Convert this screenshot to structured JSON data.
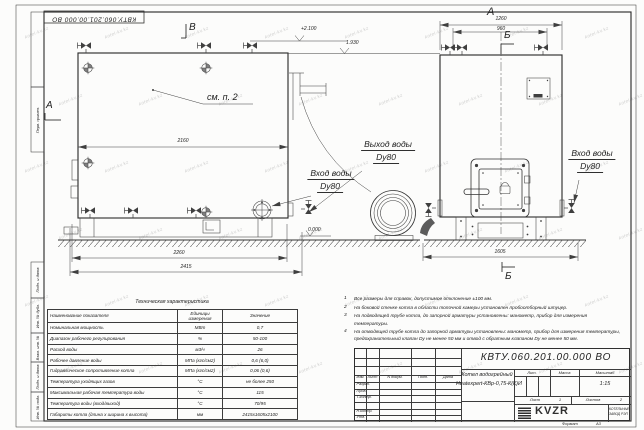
{
  "sheet": {
    "designation_stamp": "КВТУ.060.201.00.000  ВО",
    "format_label": "Формат",
    "format_value": "А3",
    "watermark": "kotel-kv.kz"
  },
  "frame_labels": {
    "perv": "Перв. примен.",
    "podp1": "Подп. и дата",
    "inv_dubl": "Инв. № дубл.",
    "vzam": "Взам. инв. №",
    "podp2": "Подп. и дата",
    "inv_podl": "Инв. № подл."
  },
  "front_view": {
    "section_v": "В",
    "section_a": "А",
    "note_ref": "см. п. 2",
    "dim_2160": "2160",
    "dim_2260": "2260",
    "dim_2415": "2415",
    "level_top": "+2.100",
    "level_chimney": "1.930",
    "level_zero": "0.000",
    "outlet_line1": "Выход воды",
    "outlet_line2": "Dy80",
    "inlet_line1": "Вход воды",
    "inlet_line2": "Dy80"
  },
  "side_view": {
    "view_label": "А",
    "dim_1260": "1260",
    "dim_960": "960",
    "dim_1605": "1605",
    "section_b_top": "Б",
    "section_b_bottom": "Б",
    "inlet_line1": "Вход воды",
    "inlet_line2": "Dy80"
  },
  "notes": [
    {
      "num": "1",
      "text": "Все размеры для справок, допустимое отклонение ±100 мм."
    },
    {
      "num": "2",
      "text": "На боковой стенке котла в области топочной камеры установлен пробоотборный штуцер."
    },
    {
      "num": "3",
      "text": "На  подводящей трубе котла, до запорной арматуры установлены: манометр, прибор для измерения\nтемпературы."
    },
    {
      "num": "4",
      "text": "На отводящей трубе котла до запорной арматуры установлены: манометр, прибор для измерения температуры,\nпредохранительный клапан Dу не менее 50 мм и отвод с обратным клапаном Dу не менее 50 мм."
    }
  ],
  "spec_table": {
    "title": "Техническая характеристика",
    "col_headers": [
      "Наименование показателя",
      "Единицы измерения",
      "Значение"
    ],
    "rows": [
      {
        "name": "Номинальная мощность",
        "unit": "МВт",
        "value": "0,7"
      },
      {
        "name": "Диапазон рабочего регулирования",
        "unit": "%",
        "value": "50-100"
      },
      {
        "name": "Расход воды",
        "unit": "м3/ч",
        "value": "26"
      },
      {
        "name": "Рабочее давление воды",
        "unit": "МПа (кгс/см2)",
        "value": "0,6 (6,0)"
      },
      {
        "name": "Гидравлическое сопротивление котла",
        "unit": "МПа (кгс/см2)",
        "value": "0,06 (0,6)"
      },
      {
        "name": "Температура уходящих газов",
        "unit": "°С",
        "value": "не более 250"
      },
      {
        "name": "Максимальная рабочая температура воды",
        "unit": "°С",
        "value": "115"
      },
      {
        "name": "Температура воды (вход/выход)",
        "unit": "°С",
        "value": "70/95"
      },
      {
        "name": "Габариты котла (длина х ширина х высота)",
        "unit": "мм",
        "value": "2415х1605х2100"
      }
    ]
  },
  "title_block": {
    "designation": "КВТУ.060.201.00.000  ВО",
    "product_line1": "Котел водогрейный",
    "product_line2": "Heatexpert-КВр-0,75-К(К)",
    "col_izm": "Изм.",
    "col_list": "Лист",
    "col_ndoc": "N докум.",
    "col_podp": "Подп.",
    "col_data": "Дата",
    "row_razrab": "Разраб.",
    "row_prov": "Пров.",
    "row_tkontr": "Т.контр.",
    "row_nkontr": "Н.контр.",
    "row_utv": "Утв.",
    "lit_label": "Лит.",
    "lit_value": "И",
    "mass_label": "Масса",
    "scale_label": "Масштаб",
    "scale_value": "1:15",
    "sheet_label": "Лист",
    "sheet_value": "1",
    "sheets_label": "Листов",
    "sheets_value": "2",
    "logo_text": "KVZR",
    "company_line1": "КОТЕЛЬНЫЙ",
    "company_line2": "ЗАВОД РЭП"
  }
}
